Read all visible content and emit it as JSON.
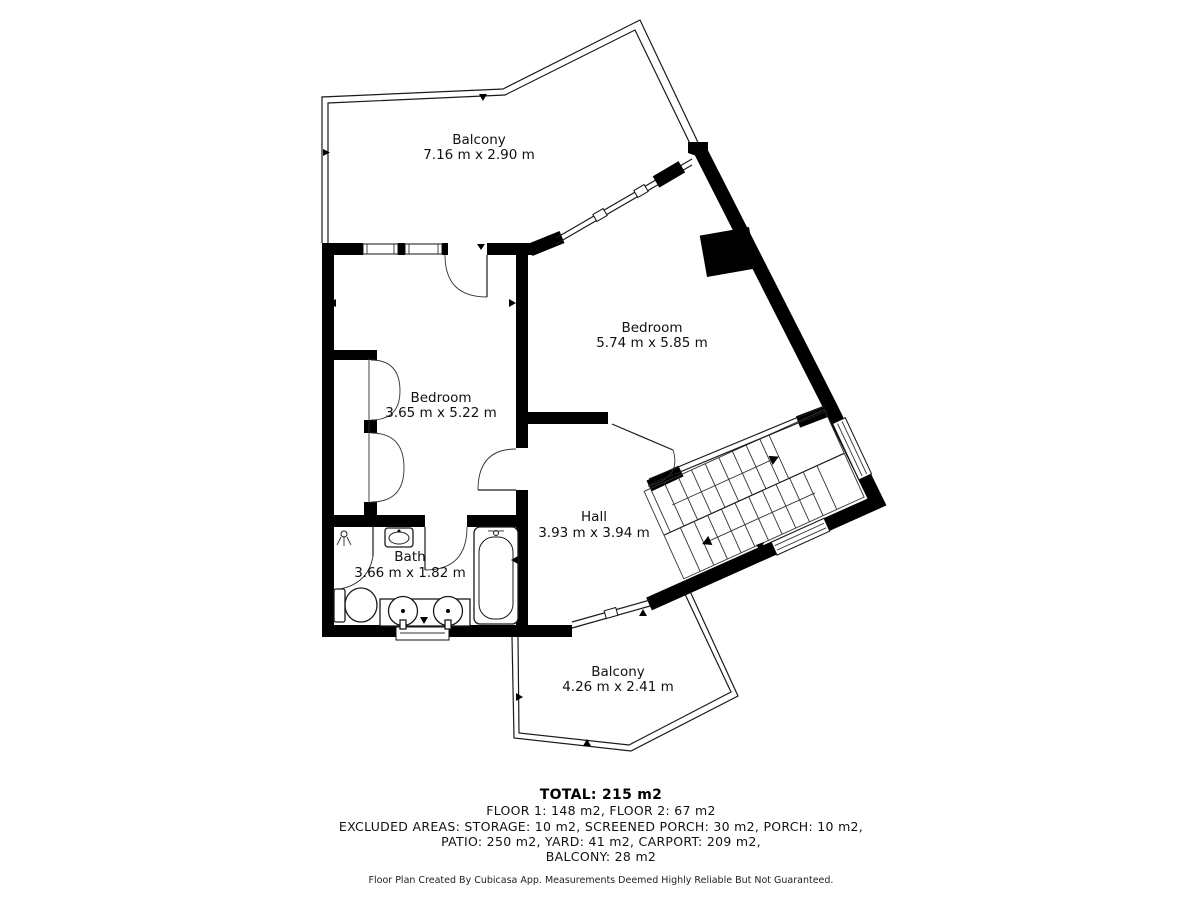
{
  "plan": {
    "rooms": [
      {
        "name": "Balcony",
        "dims": "7.16 m x 2.90 m"
      },
      {
        "name": "Bedroom",
        "dims": "5.74 m x 5.85 m"
      },
      {
        "name": "Bedroom",
        "dims": "3.65 m x 5.22 m"
      },
      {
        "name": "Hall",
        "dims": "3.93 m x 3.94 m"
      },
      {
        "name": "Bath",
        "dims": "3.66 m x 1.82 m"
      },
      {
        "name": "Balcony",
        "dims": "4.26 m x 2.41 m"
      }
    ],
    "summary": {
      "total": "TOTAL: 215 m2",
      "floors": "FLOOR 1: 148 m2, FLOOR 2: 67 m2",
      "excluded_line1": "EXCLUDED AREAS: STORAGE: 10 m2, SCREENED PORCH: 30 m2, PORCH: 10 m2,",
      "excluded_line2": "PATIO: 250 m2, YARD: 41 m2, CARPORT: 209 m2,",
      "excluded_line3": "BALCONY: 28 m2"
    },
    "footer": "Floor Plan Created By Cubicasa App. Measurements Deemed Highly Reliable But Not Guaranteed.",
    "colors": {
      "wall": "#000000",
      "text": "#111111",
      "background": "#ffffff"
    }
  }
}
